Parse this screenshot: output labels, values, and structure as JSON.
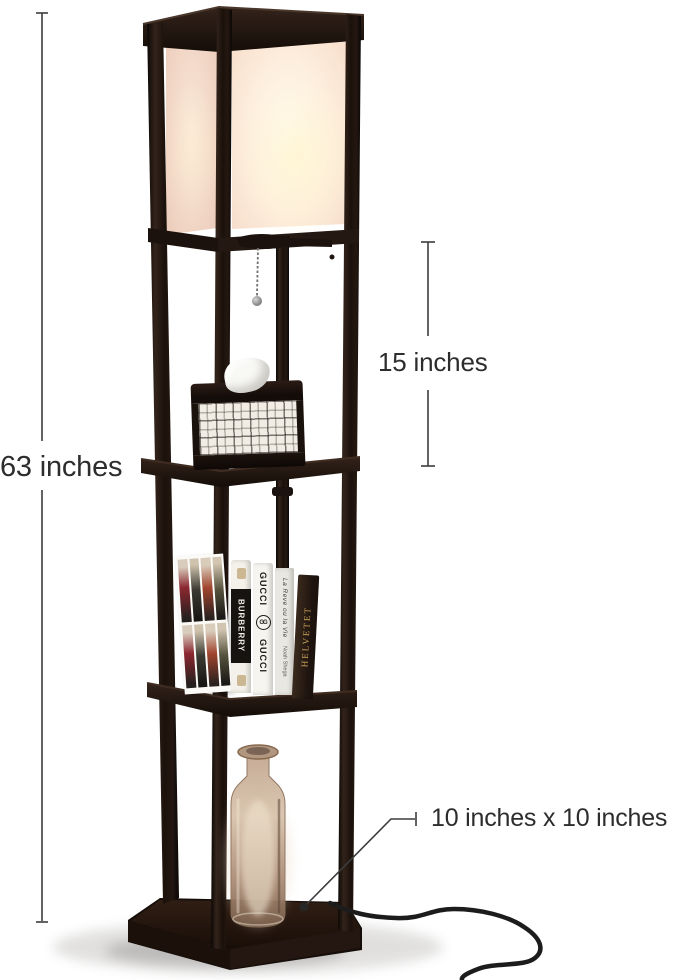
{
  "image_type": "product photo of a shelf floor lamp with dimension callouts",
  "annotations": {
    "total_height": "63 inches",
    "lamp_section_height": "15 inches",
    "base_dimensions": "10 inches x 10 inches"
  },
  "props": {
    "books": {
      "burberry": "BURBERRY",
      "gucci_top": "GUCCI",
      "gucci_logo": "GG",
      "gucci_bottom": "GUCCI",
      "lareve_title": "La Reve ou la Vie",
      "lareve_author": "Noah Shega",
      "helvetet": "HELVETET"
    }
  },
  "colors": {
    "background": "#ffffff",
    "frame_wood": "#241712",
    "shade_front_glow": "#fdf0de",
    "shade_side": "#f0d4c4",
    "annotation_ink": "#2d2d2d",
    "bottle_glass": "#b2937b",
    "cord": "#1c1c1c"
  }
}
